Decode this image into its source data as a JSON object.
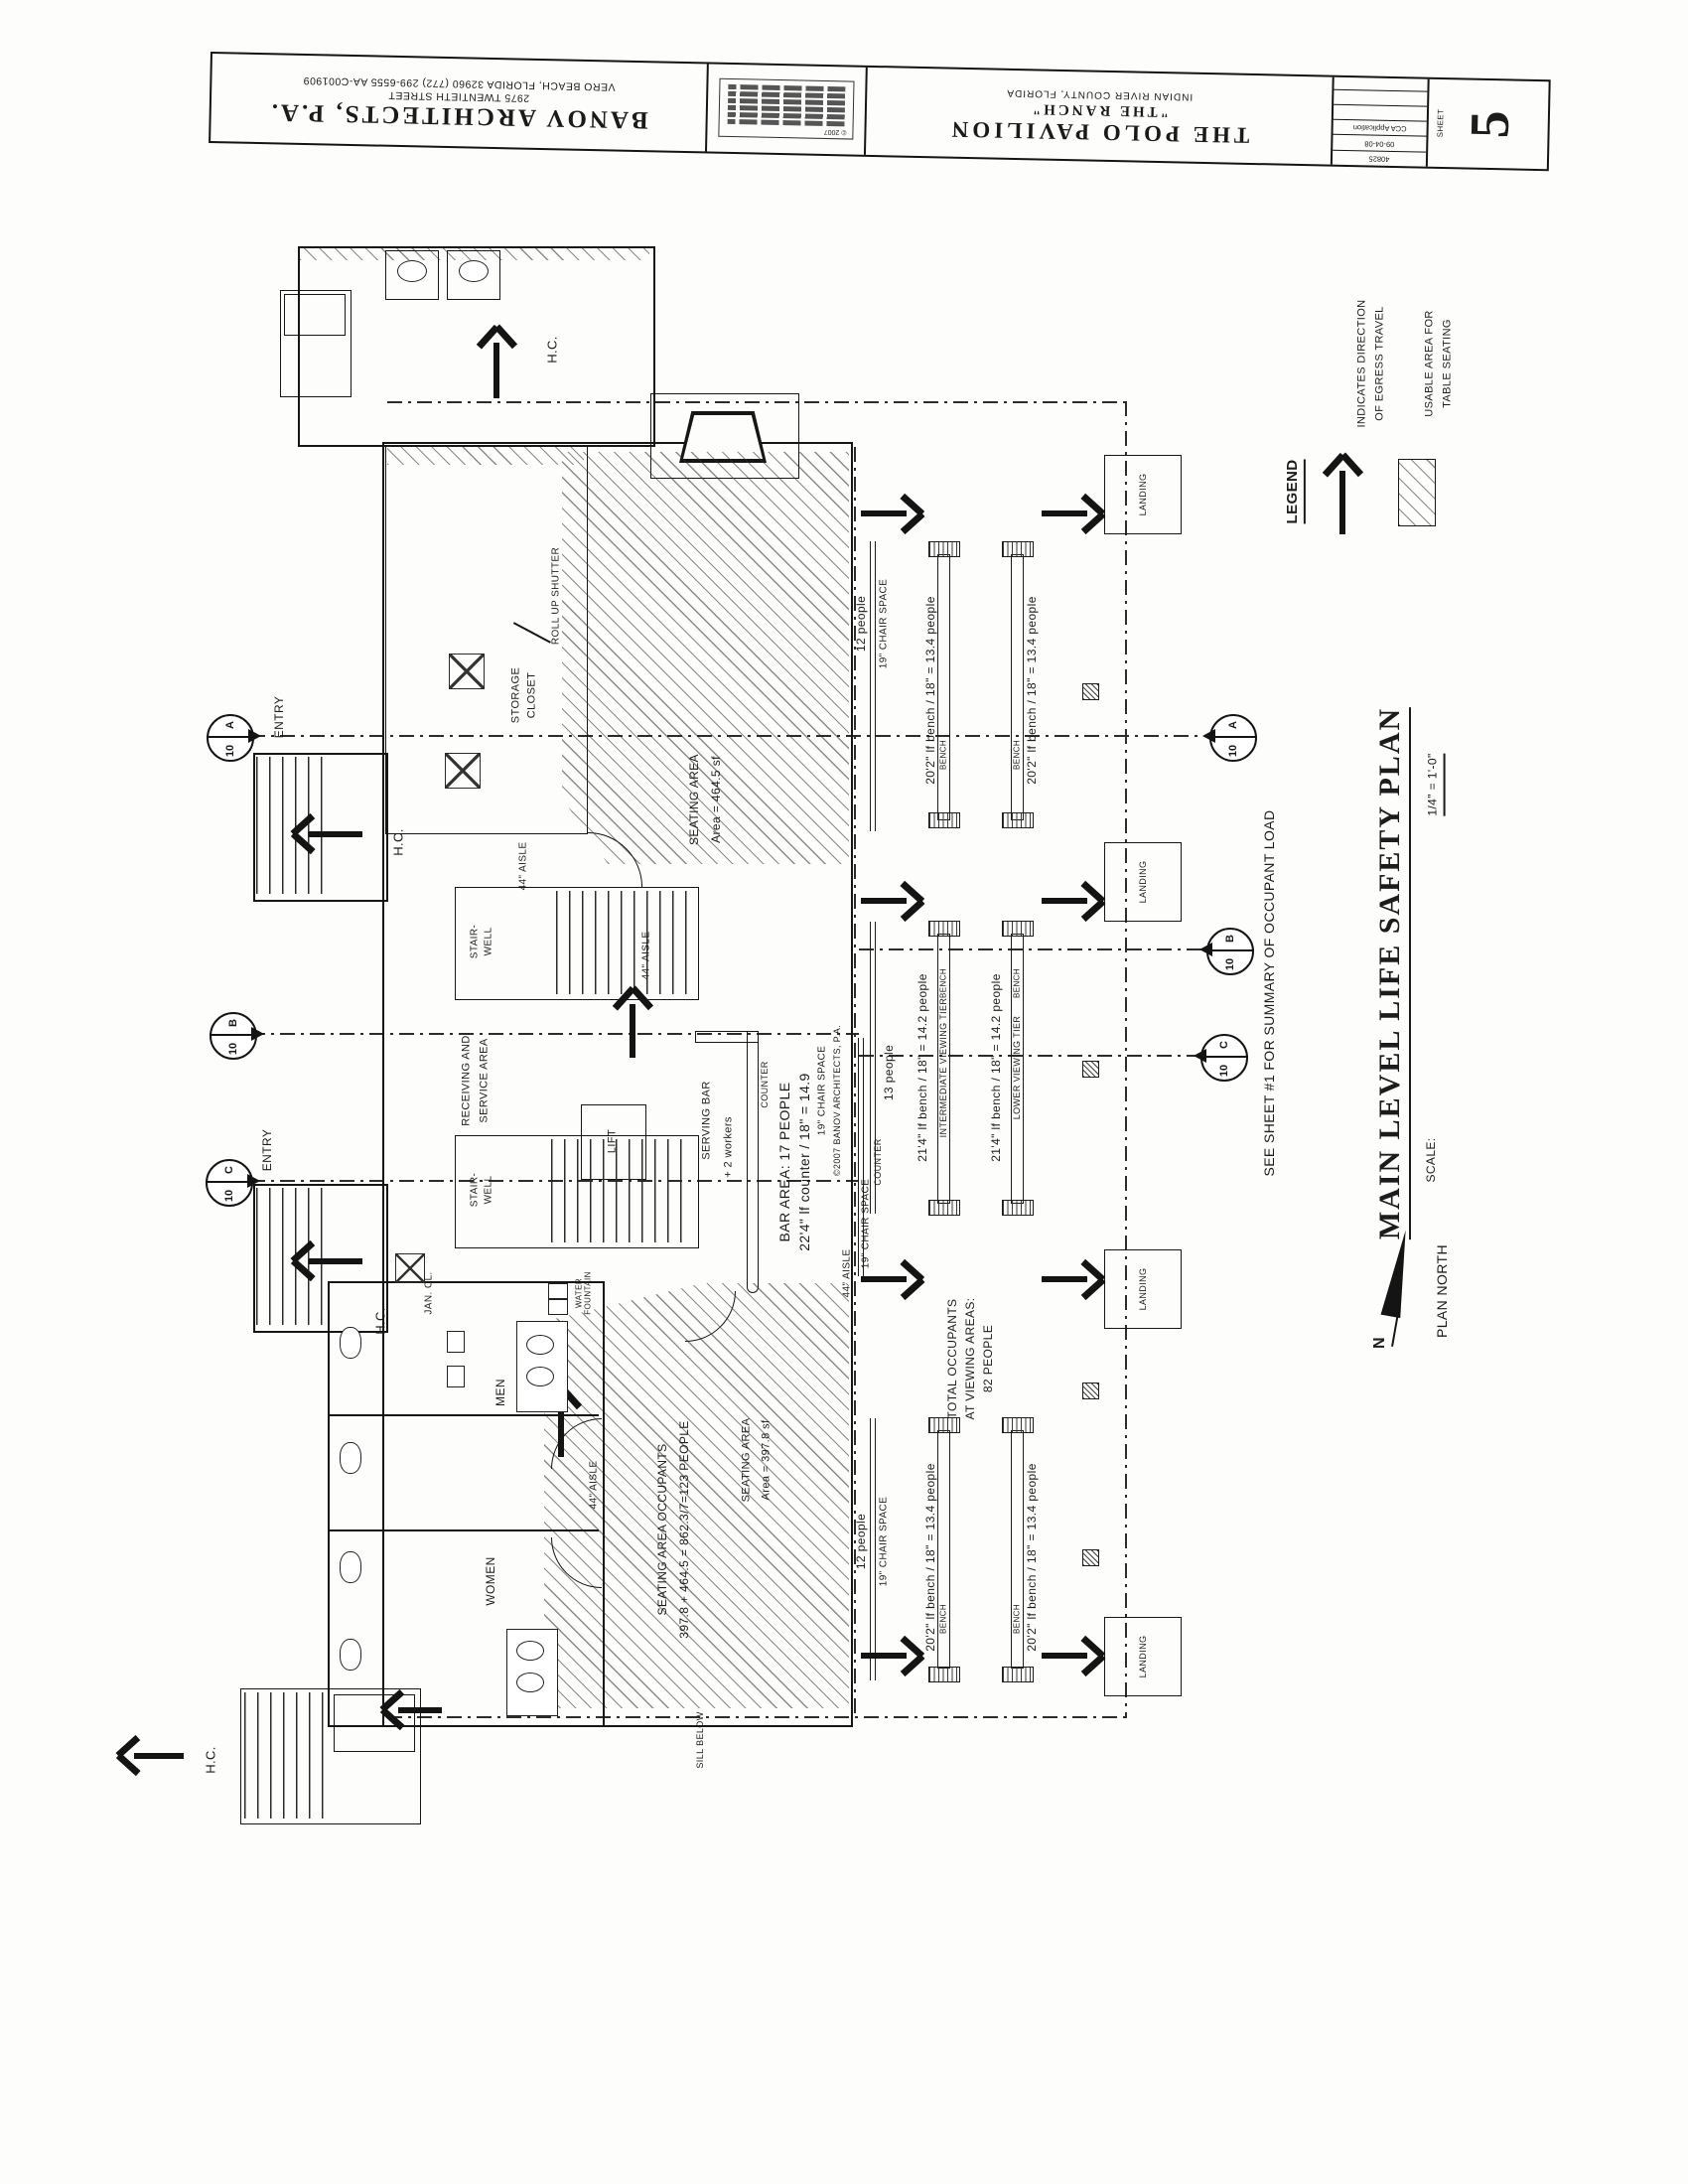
{
  "title_block": {
    "firm_name": "BANOV ARCHITECTS, P.A.",
    "firm_address1": "2975 TWENTIETH STREET",
    "firm_address2": "VERO BEACH, FLORIDA 32960 (772) 299-6555 AA-C001909",
    "copyright": "© 2007",
    "project_name": "THE POLO PAVILION",
    "project_sub": "\"THE RANCH\"",
    "project_location": "INDIAN RIVER COUNTY, FLORIDA",
    "revisions": [
      "40825",
      "09-04-08",
      "CCA Application",
      "",
      "",
      ""
    ],
    "sheet_label": "SHEET",
    "sheet_number": "5"
  },
  "legend": {
    "title": "LEGEND",
    "egress_caption1": "INDICATES DIRECTION",
    "egress_caption2": "OF EGRESS TRAVEL",
    "seating_caption1": "USABLE AREA FOR",
    "seating_caption2": "TABLE SEATING"
  },
  "titles": {
    "main": "MAIN LEVEL LIFE SAFETY PLAN",
    "scale_label": "SCALE:",
    "scale_value": "1/4\" = 1'-0\"",
    "north": "PLAN NORTH",
    "north_letter": "N",
    "see_note": "SEE SHEET #1 FOR SUMMARY OF OCCUPANT LOAD"
  },
  "rooms": {
    "entry": "ENTRY",
    "stair1": "STAIR-",
    "stair2": "WELL",
    "receiving1": "RECEIVING AND",
    "receiving2": "SERVICE AREA",
    "lift": "LIFT",
    "storage1": "STORAGE",
    "storage2": "CLOSET",
    "roll_up": "ROLL UP SHUTTER",
    "serving_bar": "SERVING BAR",
    "women": "WOMEN",
    "men": "MEN",
    "jan": "JAN. CL.",
    "water1": "WATER",
    "water2": "FOUNTAIN",
    "landing": "LANDING",
    "bench": "BENCH",
    "hc": "H.C.",
    "aisle": "44\" AISLE",
    "chair_space": "19\" CHAIR SPACE",
    "counter": "COUNTER",
    "sill": "SILL BELOW"
  },
  "labels": {
    "seating_upper1": "SEATING AREA",
    "seating_upper2": "Area = 464.5 sf",
    "seating_lower1": "SEATING AREA",
    "seating_lower2": "Area = 397.8 sf",
    "occupants1": "SEATING AREA OCCUPANTS",
    "occupants2": "397.8 + 464.5 = 862.3/7=123 PEOPLE",
    "bar1": "BAR AREA: 17 PEOPLE",
    "bar2": "22'4\" lf counter / 18\" = 14.9",
    "workers": "+ 2 workers",
    "plan_copyright": "©2007 BANOV ARCHITECTS, P.A.",
    "bench_202": "20'2\" lf bench / 18\" = 13.4 people",
    "bench_214": "21'4\" lf bench / 18\" = 14.2 people",
    "tier_intermediate": "INTERMEDIATE VIEWING TIER",
    "tier_lower": "LOWER VIEWING TIER",
    "people12": "12 people",
    "people13": "13 people",
    "total1": "TOTAL OCCUPANTS",
    "total2": "AT VIEWING AREAS:",
    "total3": "82 PEOPLE"
  },
  "markers": {
    "a": "A",
    "b": "B",
    "c": "C",
    "ten": "10"
  }
}
